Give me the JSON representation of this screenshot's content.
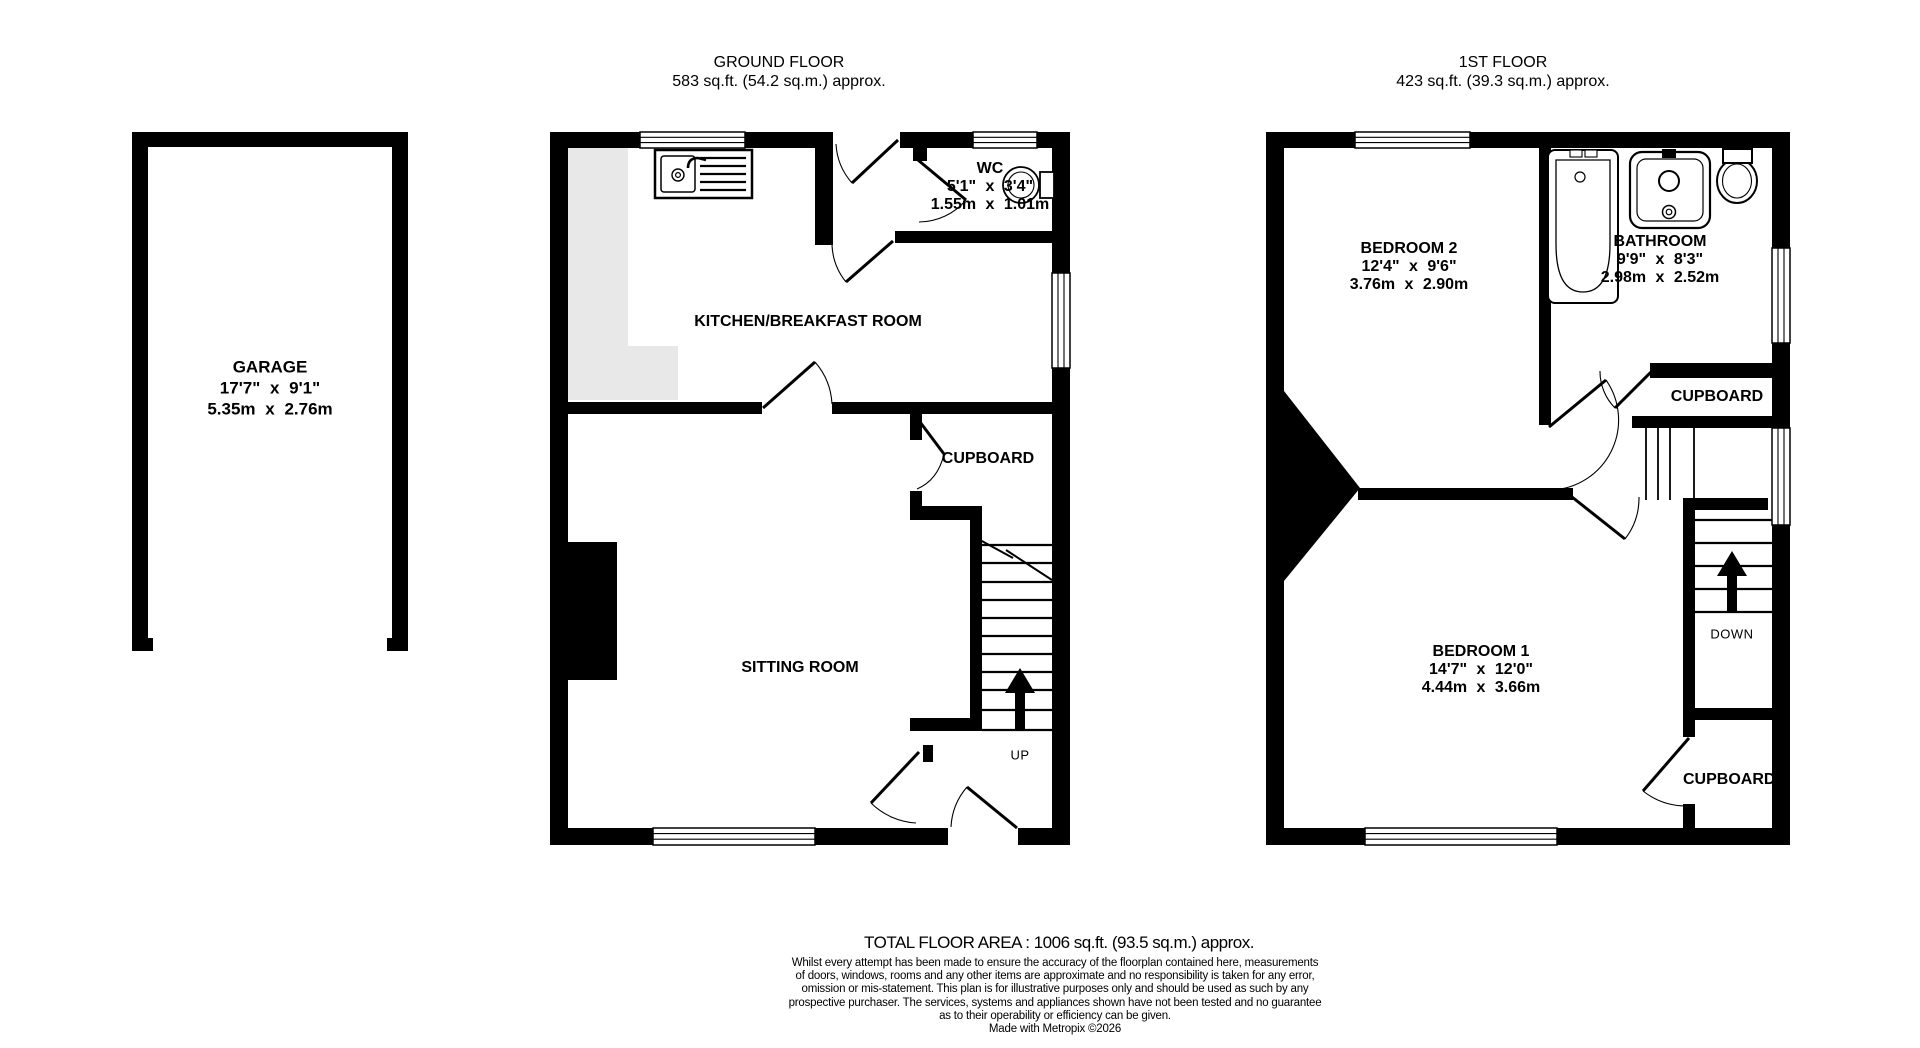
{
  "titles": {
    "ground": {
      "line1": "GROUND FLOOR",
      "line2": "583 sq.ft. (54.2 sq.m.) approx."
    },
    "first": {
      "line1": "1ST FLOOR",
      "line2": "423 sq.ft. (39.3 sq.m.) approx."
    }
  },
  "garage": {
    "name": "GARAGE",
    "dims_ft": "17'7\" x 9'1\"",
    "dims_m": "5.35m x 2.76m"
  },
  "ground": {
    "kitchen": {
      "name": "KITCHEN/BREAKFAST ROOM"
    },
    "wc": {
      "name": "WC",
      "dims_ft": "5'1\" x 3'4\"",
      "dims_m": "1.55m x 1.01m"
    },
    "cupboard": {
      "name": "CUPBOARD"
    },
    "sitting": {
      "name": "SITTING ROOM"
    },
    "stairs": {
      "label": "UP"
    }
  },
  "first": {
    "bedroom2": {
      "name": "BEDROOM 2",
      "dims_ft": "12'4\" x 9'6\"",
      "dims_m": "3.76m x 2.90m"
    },
    "bathroom": {
      "name": "BATHROOM",
      "dims_ft": "9'9\" x 8'3\"",
      "dims_m": "2.98m x 2.52m"
    },
    "cupboard_top": {
      "name": "CUPBOARD"
    },
    "bedroom1": {
      "name": "BEDROOM 1",
      "dims_ft": "14'7\" x 12'0\"",
      "dims_m": "4.44m x 3.66m"
    },
    "stairs": {
      "label": "DOWN"
    },
    "cupboard_bottom": {
      "name": "CUPBOARD"
    }
  },
  "footer": {
    "total": "TOTAL FLOOR AREA : 1006 sq.ft. (93.5 sq.m.) approx.",
    "disclaimer": [
      "Whilst every attempt has been made to ensure the accuracy of the floorplan contained here, measurements",
      "of doors, windows, rooms and any other items are approximate and no responsibility is taken for any error,",
      "omission or mis-statement. This plan is for illustrative purposes only and should be used as such by any",
      "prospective purchaser. The services, systems and appliances shown have not been tested and no guarantee",
      "as to their operability or efficiency can be given."
    ],
    "credit": "Made with Metropix ©2026"
  },
  "colors": {
    "wall": "#000000",
    "counter": "#e8e8e8",
    "background": "#ffffff"
  }
}
